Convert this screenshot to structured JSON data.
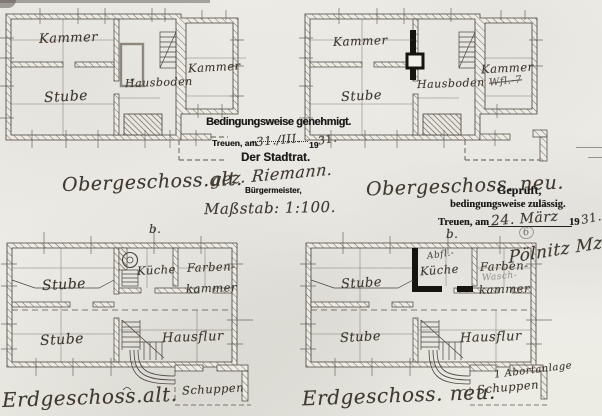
{
  "scale": {
    "note": "Maßstab: 1:100."
  },
  "approval": {
    "line1": "Bedingungsweise genehmigt.",
    "place_label": "Treuen, am",
    "date_handwritten": "31./III.",
    "year_prefix": "19",
    "year_handwritten": "31.",
    "authority": "Der Stadtrat.",
    "signature": "gez. Riemann.",
    "signer_title": "Bürgermeister,"
  },
  "review": {
    "line1": "Geprüft,",
    "line2": "bedingungsweise zulässig.",
    "place_label": "Treuen, am",
    "date_handwritten": "24. März",
    "year_prefix": "19",
    "year_handwritten": "31.",
    "mark": "6",
    "signature": "Pölnitz Mz."
  },
  "og_alt": {
    "title": "Obergeschoss.alt.",
    "kammer_left": "Kammer",
    "stube": "Stube",
    "hausboden": "Hausboden",
    "kammer_right": "Kammer"
  },
  "og_neu": {
    "title": "Obergeschoss. neu.",
    "kammer_left": "Kammer",
    "stube": "Stube",
    "hausboden": "Hausboden",
    "kammer_right": "Kammer",
    "kammer_note": "Wfl.-7"
  },
  "eg_alt": {
    "title": "Erdgeschoss.alt.",
    "marker": "b.",
    "stube_top": "Stube",
    "kueche": "Küche",
    "farben1": "Farben-",
    "farben2": "kammer",
    "stube_bottom": "Stube",
    "hausflur": "Hausflur",
    "schuppen": "Schuppen"
  },
  "eg_neu": {
    "title": "Erdgeschoss. neu.",
    "marker": "b.",
    "stube_top": "Stube",
    "kueche": "Küche",
    "kueche_note": "Abfl.-",
    "farben1": "Farben-",
    "farben2": "kammer",
    "farben_note": "Wasch-",
    "stube_bottom": "Stube",
    "hausflur": "Hausflur",
    "schuppen": "Schuppen",
    "schuppen_note": "1 Abortanlage"
  }
}
